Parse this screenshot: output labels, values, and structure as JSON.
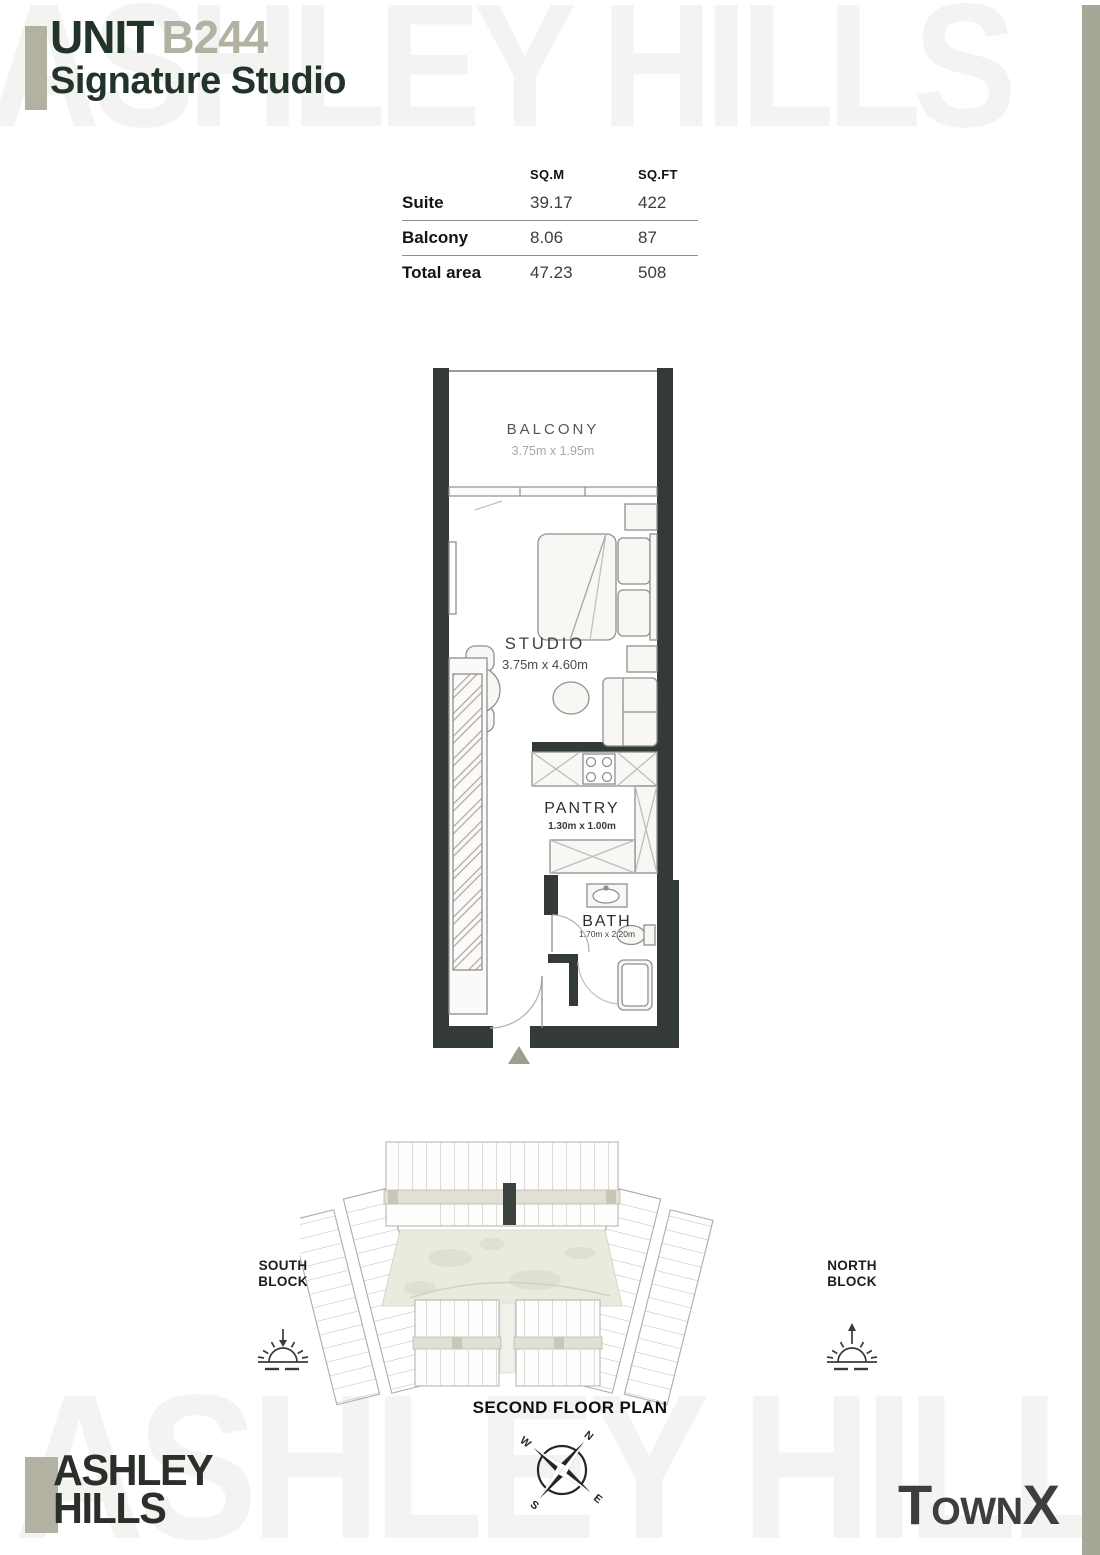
{
  "header": {
    "unit_label": "UNIT",
    "unit_number": "B244",
    "subtitle": "Signature Studio"
  },
  "watermark_text": "ASHLEY HILLS",
  "area_table": {
    "columns": {
      "sqm": "SQ.M",
      "sqft": "SQ.FT"
    },
    "rows": [
      {
        "label": "Suite",
        "sqm": "39.17",
        "sqft": "422"
      },
      {
        "label": "Balcony",
        "sqm": "8.06",
        "sqft": "87"
      },
      {
        "label": "Total area",
        "sqm": "47.23",
        "sqft": "508"
      }
    ]
  },
  "floor_plan": {
    "rooms": [
      {
        "name": "BALCONY",
        "dims": "3.75m x 1.95m"
      },
      {
        "name": "STUDIO",
        "dims": "3.75m x 4.60m"
      },
      {
        "name": "PANTRY",
        "dims": "1.30m x 1.00m"
      },
      {
        "name": "BATH",
        "dims": "1.70m x 2.20m"
      }
    ]
  },
  "key_plan": {
    "south_block": {
      "line1": "SOUTH",
      "line2": "BLOCK"
    },
    "north_block": {
      "line1": "NORTH",
      "line2": "BLOCK"
    },
    "caption": "SECOND FLOOR PLAN",
    "compass": {
      "north": "N",
      "east": "E",
      "south": "S",
      "west": "W"
    }
  },
  "footer": {
    "brand": {
      "line1": "ASHLEY",
      "line2": "HILLS"
    },
    "developer": {
      "part1": "T",
      "part2": "OWN",
      "part3": "X"
    }
  },
  "colors": {
    "brand_green": "#22332a",
    "brand_taupe": "#b3b1a2",
    "edge_bar": "#a5a896",
    "wall": "#343b36",
    "watermark": "#f3f3f2",
    "courtyard": "#e9ebdf",
    "highlight_unit": "#3c423d"
  }
}
